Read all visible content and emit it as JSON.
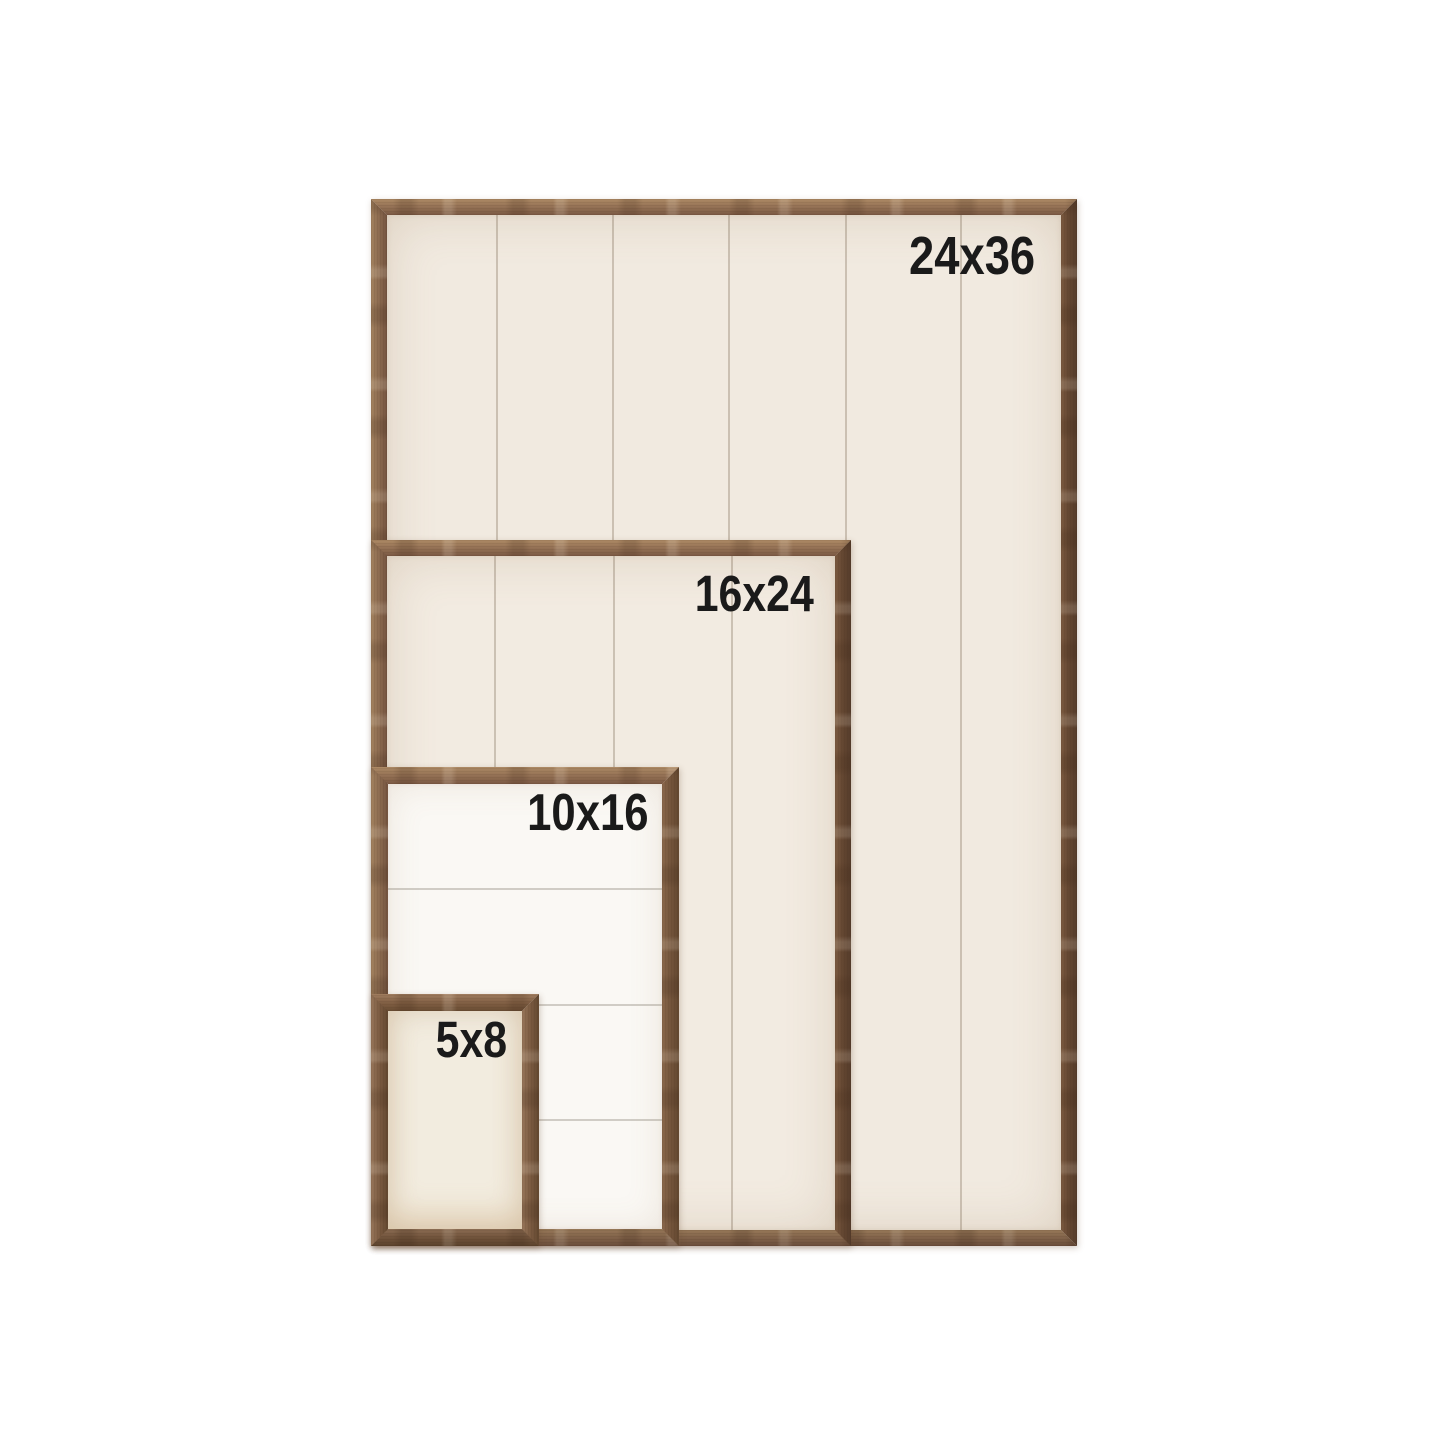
{
  "photo": {
    "description": "Size comparison of nested rustic wood frame shiplap signs on white background",
    "background_color": "#ffffff",
    "wood_color": "#8c6b50",
    "wood_dark_color": "#5d4433",
    "panel_cream_color": "#f1eae0",
    "panel_white_color": "#faf8f4",
    "label_color": "#1a1a1a"
  },
  "frames": [
    {
      "label": "24x36",
      "panel_style": "cream shiplap, vertical planks"
    },
    {
      "label": "16x24",
      "panel_style": "cream shiplap, vertical planks"
    },
    {
      "label": "10x16",
      "panel_style": "white shiplap, horizontal planks"
    },
    {
      "label": "5x8",
      "panel_style": "plain cream panel"
    }
  ]
}
